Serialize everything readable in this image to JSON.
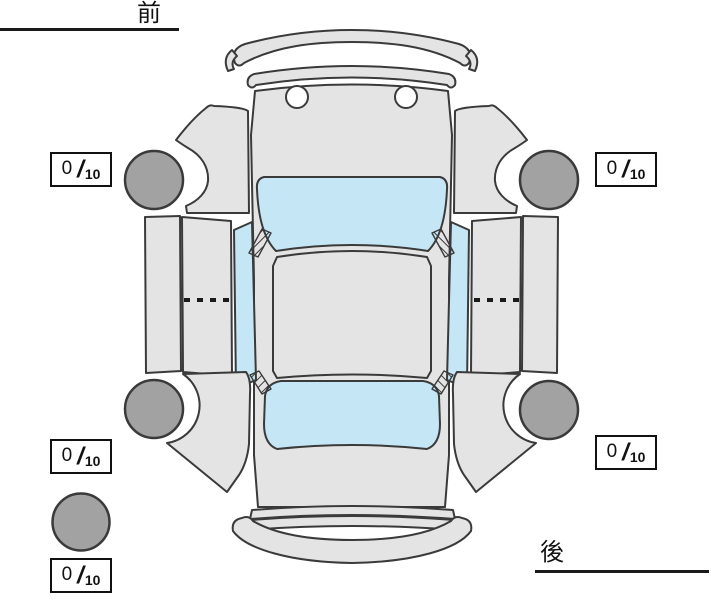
{
  "diagram": {
    "front_label": "前",
    "rear_label": "後",
    "tread_unit": {
      "slash": "/",
      "max": "10"
    },
    "treads": {
      "front_left": {
        "value": "0"
      },
      "front_right": {
        "value": "0"
      },
      "rear_left": {
        "value": "0"
      },
      "rear_right": {
        "value": "0"
      },
      "spare": {
        "value": "0"
      }
    },
    "colors": {
      "body": "#e4e4e4",
      "glass": "#c5e6f4",
      "tire": "#a2a2a2",
      "outline": "#3a3a3a",
      "line": "#1a1a1a"
    }
  }
}
